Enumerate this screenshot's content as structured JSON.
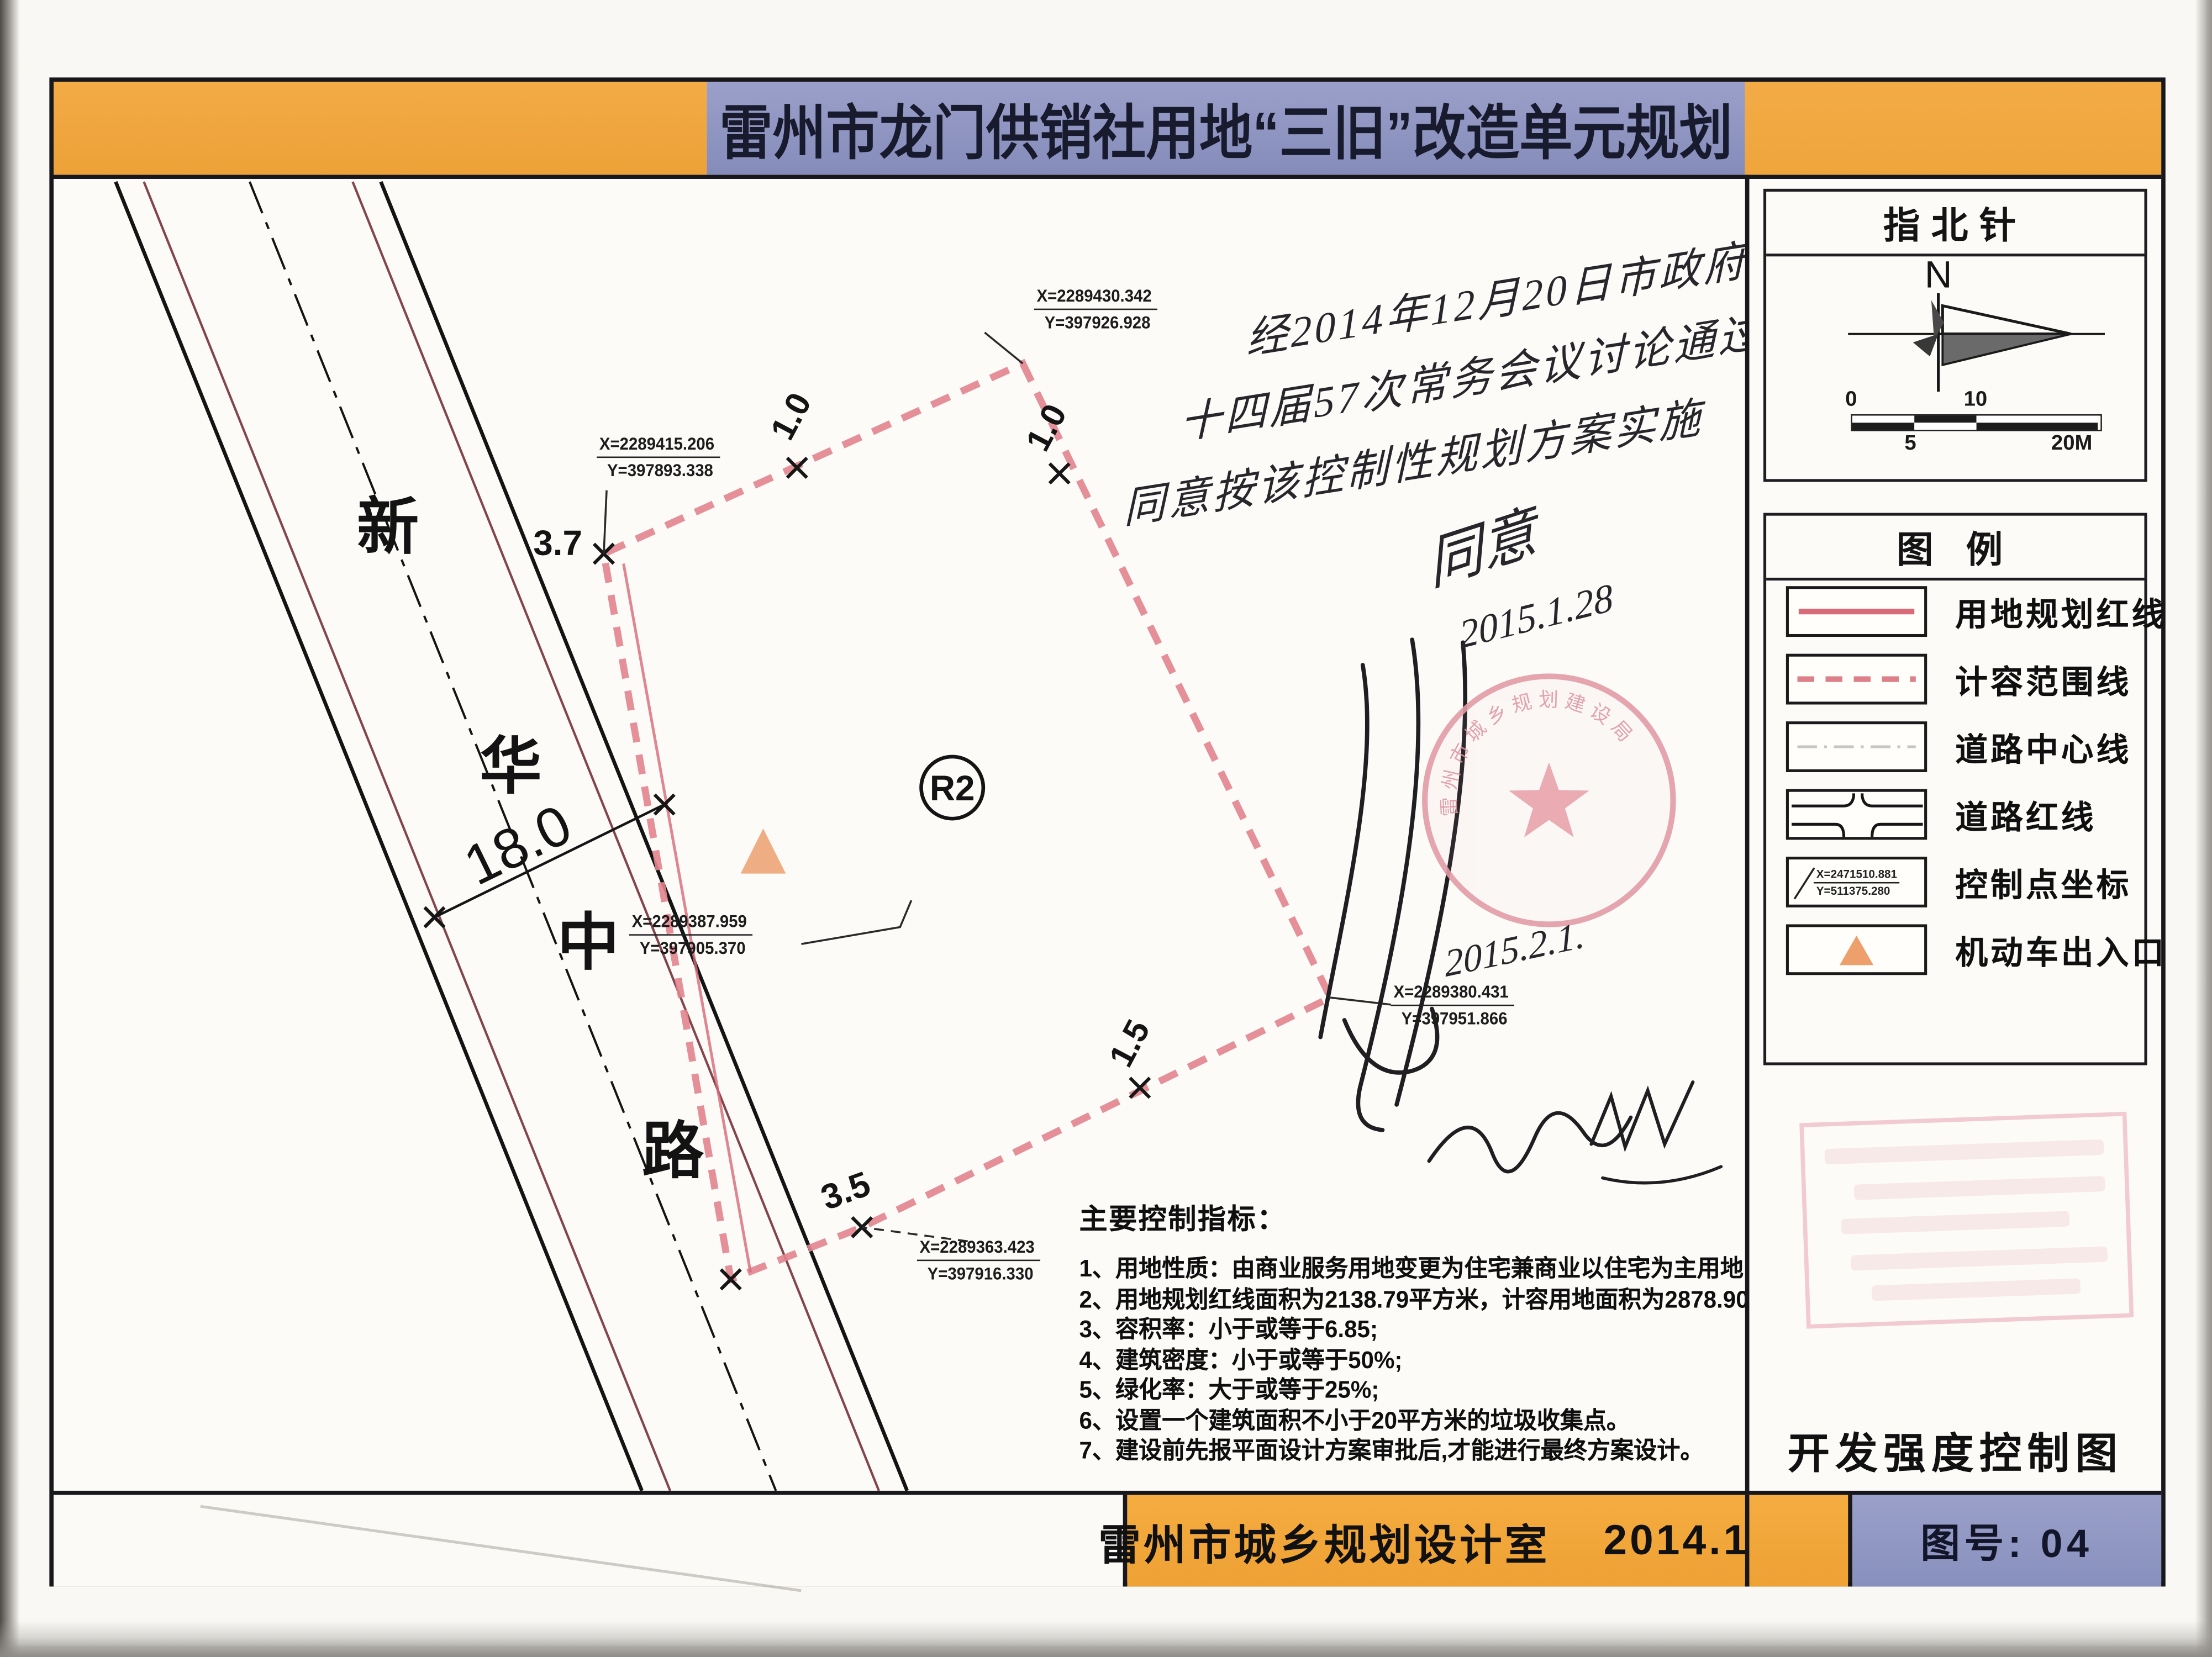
{
  "title": "雷州市龙门供销社用地“三旧”改造单元规划",
  "north": {
    "header": "指北针",
    "letter": "N",
    "scale": {
      "zero": "0",
      "five": "5",
      "ten": "10",
      "twenty": "20M"
    }
  },
  "legend": {
    "header": "图 例",
    "items": [
      "用地规划红线",
      "计容范围线",
      "道路中心线",
      "道路红线",
      "控制点坐标",
      "机动车出入口"
    ],
    "coord_sample": {
      "x": "X=2471510.881",
      "y": "Y=511375.280"
    }
  },
  "sidebar": {
    "map_type": "开发强度控制图",
    "sheet_no": "图号: 04"
  },
  "footer": {
    "credit": "雷州市城乡规划设计室",
    "date": "2014.11"
  },
  "road": {
    "name_chars": [
      "新",
      "华",
      "中",
      "路"
    ],
    "width_label": "18.0"
  },
  "parcel": {
    "zone": "R2",
    "dims": {
      "top_left": "3.7",
      "top": "1.0",
      "top_right": "1.0",
      "bottom_right": "1.5",
      "bottom_left": "3.5"
    }
  },
  "coords": {
    "top": {
      "x": "X=2289430.342",
      "y": "Y=397926.928"
    },
    "left": {
      "x": "X=2289415.206",
      "y": "Y=397893.338"
    },
    "center": {
      "x": "X=2289387.959",
      "y": "Y=397905.370"
    },
    "right": {
      "x": "X=2289380.431",
      "y": "Y=397951.866"
    },
    "bottom": {
      "x": "X=2289363.423",
      "y": "Y=397916.330"
    }
  },
  "indicators": {
    "heading": "主要控制指标：",
    "items": [
      "1、用地性质：由商业服务用地变更为住宅兼商业以住宅为主用地;",
      "2、用地规划红线面积为2138.79平方米，计容用地面积为2878.90平方米;",
      "3、容积率：小于或等于6.85;",
      "4、建筑密度：小于或等于50%;",
      "5、绿化率：大于或等于25%;",
      "6、设置一个建筑面积不小于20平方米的垃圾收集点。",
      "7、建设前先报平面设计方案审批后,才能进行最终方案设计。"
    ]
  },
  "handwriting": {
    "note_lines": [
      "经2014年12月20日市政府",
      "十四届57次常务会议讨论通过，",
      "同意按该控制性规划方案实施"
    ],
    "agree": "同意",
    "agree_date": "2015.1.28",
    "stamp_date": "2015.2.1.",
    "stamp_arc": "雷州市城乡规划建设局"
  },
  "colors": {
    "banner_orange": "#f2a73e",
    "banner_blue": "#8f96c4",
    "red_line": "#d96b78",
    "dash_pink": "#e2848e",
    "entrance_orange": "#eda06b",
    "stamp_pink": "#e39ca6"
  }
}
